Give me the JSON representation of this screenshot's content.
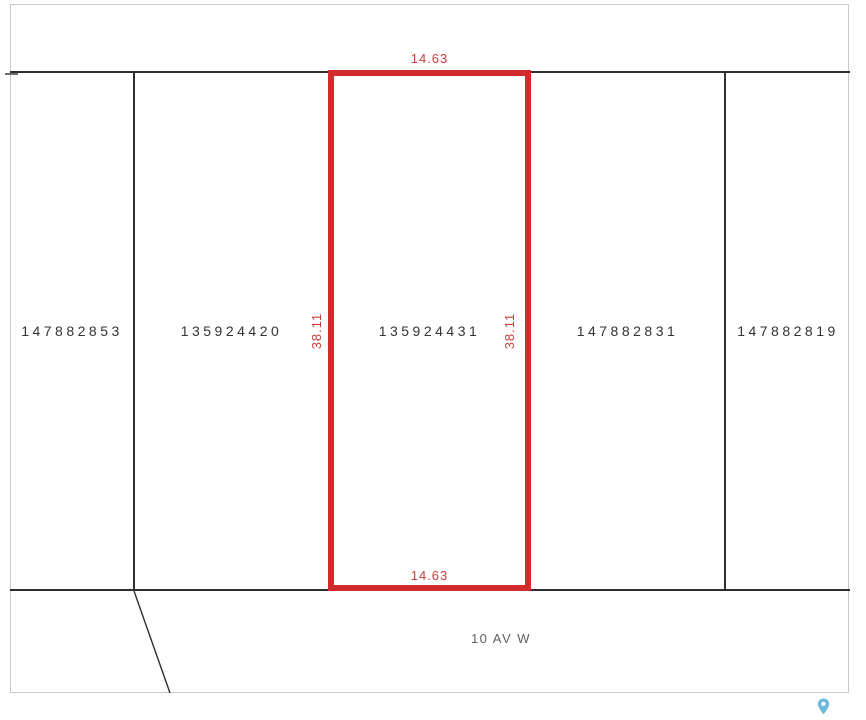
{
  "map": {
    "parcels": [
      {
        "id": "147882853",
        "selected": false
      },
      {
        "id": "135924420",
        "selected": false
      },
      {
        "id": "135924431",
        "selected": true
      },
      {
        "id": "147882831",
        "selected": false
      },
      {
        "id": "147882819",
        "selected": false
      }
    ],
    "selected_parcel": {
      "id": "135924431",
      "frontage": "14.63",
      "depth": "38.11"
    },
    "dimensions": {
      "top": "14.63",
      "bottom": "14.63",
      "left": "38.11",
      "right": "38.11"
    },
    "street": {
      "label": "10 AV W"
    },
    "icons": {
      "pin": "location-pin-icon"
    },
    "colors": {
      "highlight_outline": "#d22b2b",
      "dimension_text": "#c5403d",
      "parcel_line": "#2f2f2f",
      "frame_border": "#c9c9c9",
      "parcel_text": "#333333",
      "street_text": "#606060",
      "pin": "#6cb9dc"
    }
  }
}
